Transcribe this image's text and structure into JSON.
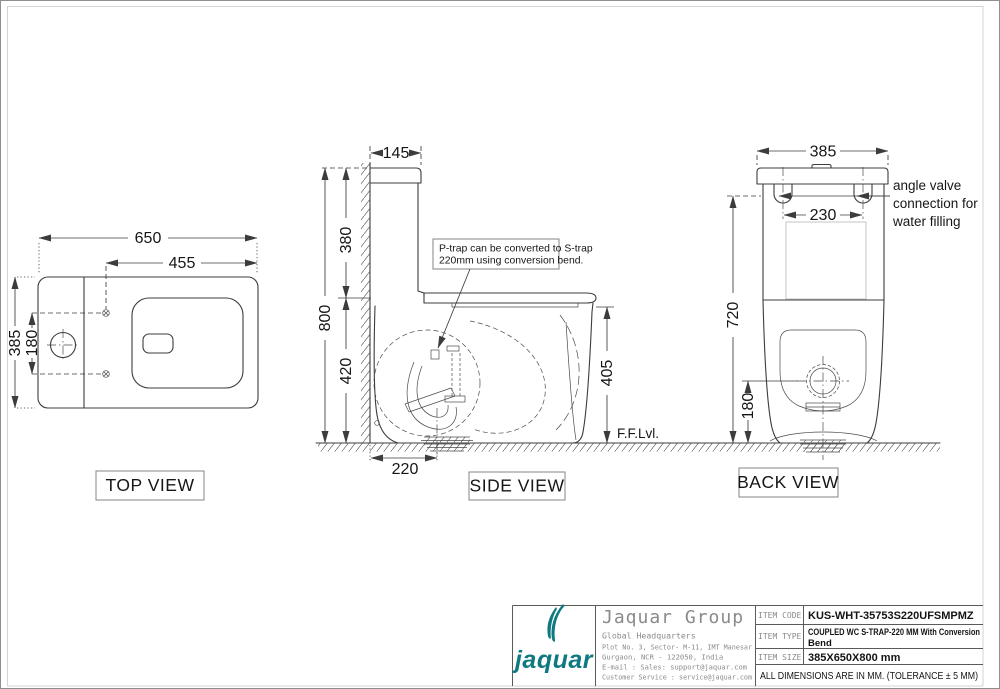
{
  "views": {
    "top": {
      "label": "TOP VIEW",
      "dim_width": "650",
      "dim_seat_offset": "455",
      "dim_depth": "385",
      "dim_bolt_spacing": "180"
    },
    "side": {
      "label": "SIDE VIEW",
      "dim_tank_top_depth": "145",
      "dim_tank_height": "380",
      "dim_total_height": "800",
      "dim_bowl_height": "420",
      "dim_trap_offset": "220",
      "dim_rim_height": "405",
      "note_lines": [
        "P-trap can be converted to S-trap",
        "220mm using conversion bend."
      ],
      "floor_level_label": "F.F.Lvl."
    },
    "back": {
      "label": "BACK VIEW",
      "dim_width": "385",
      "dim_inlet_spacing": "230",
      "dim_height": "720",
      "dim_outlet_height": "180",
      "callout_lines": [
        "angle valve",
        "connection for",
        "water filling"
      ]
    }
  },
  "title_block": {
    "brand_color": "#0e7980",
    "logo_wordmark": "jaquar",
    "company_name": "Jaquar Group",
    "address_lines": [
      "Global Headquarters",
      "Plot No. 3, Sector- M-11, IMT Manesar",
      "Gurgaon, NCR - 122050, India",
      "E-mail : Sales: support@jaquar.com",
      "Customer Service : service@jaquar.com"
    ],
    "rows": [
      {
        "label": "ITEM  CODE",
        "value_lines": [
          "KUS-WHT-35753S220UFSMPMZ"
        ]
      },
      {
        "label": "ITEM  TYPE",
        "value_lines": [
          "COUPLED WC S-TRAP-220 MM  With Conversion",
          "Bend"
        ]
      },
      {
        "label": "ITEM  SIZE",
        "value_lines": [
          "385X650X800 mm"
        ]
      }
    ],
    "footer_note": "ALL DIMENSIONS ARE IN MM. (TOLERANCE ± 5 MM)"
  }
}
